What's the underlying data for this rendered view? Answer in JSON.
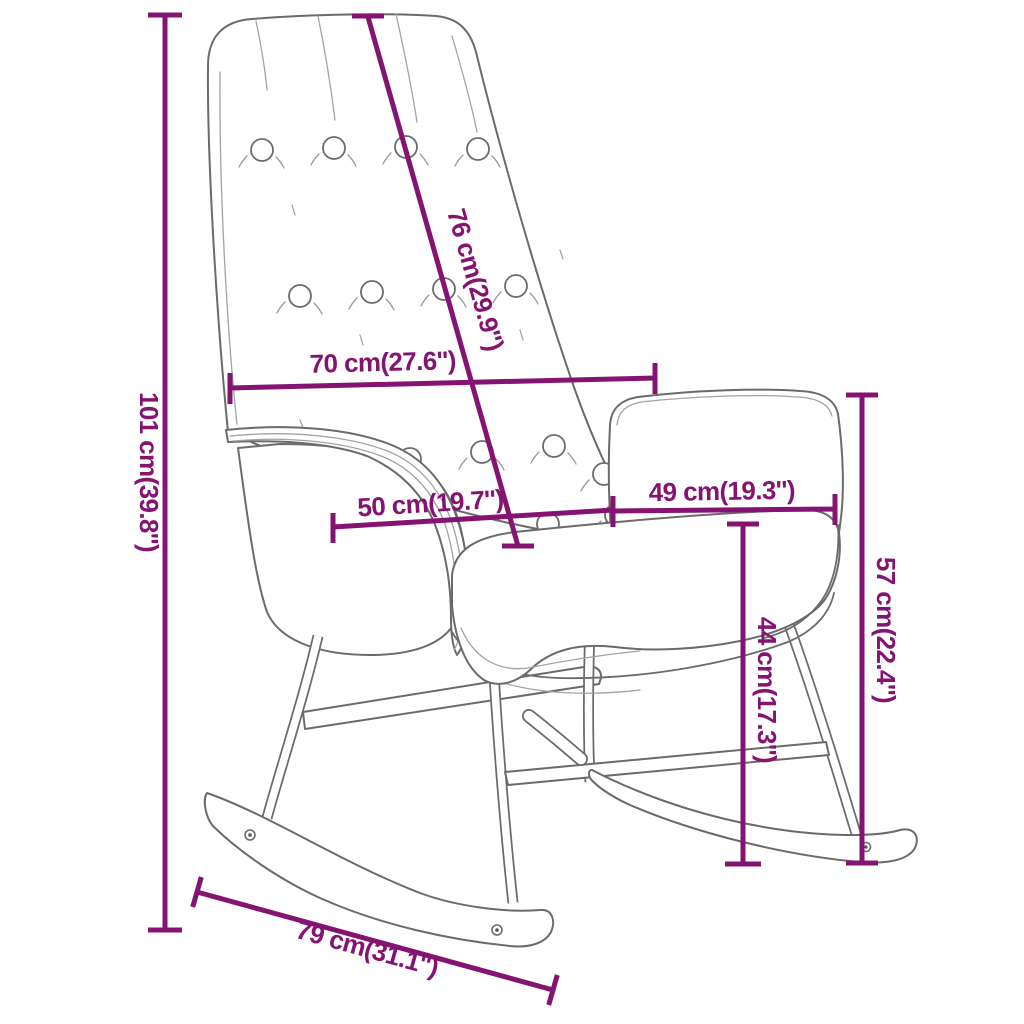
{
  "page": {
    "title": "Rocking chair dimension diagram",
    "background_color": "#ffffff"
  },
  "style": {
    "dimension_color": "#841372",
    "chair_outline_color": "#6b6b6b",
    "chair_detail_color": "#a3a3a3"
  },
  "product": {
    "type": "rocking chair",
    "view": "three-quarter line drawing with button-tufted backrest, armrest, seat cushion, metal legs and rocker runners"
  },
  "measurements": [
    {
      "id": "overall-height",
      "label": "101 cm(39.8'')",
      "cm": 101,
      "inches": 39.8,
      "orientation": "vertical"
    },
    {
      "id": "backrest-length",
      "label": "76 cm(29.9'')",
      "cm": 76,
      "inches": 29.9,
      "orientation": "diagonal"
    },
    {
      "id": "backrest-width",
      "label": "70 cm(27.6'')",
      "cm": 70,
      "inches": 27.6,
      "orientation": "horizontal"
    },
    {
      "id": "seat-width",
      "label": "50 cm(19.7'')",
      "cm": 50,
      "inches": 19.7,
      "orientation": "horizontal"
    },
    {
      "id": "armrest-depth",
      "label": "49 cm(19.3'')",
      "cm": 49,
      "inches": 19.3,
      "orientation": "horizontal"
    },
    {
      "id": "armrest-height",
      "label": "57 cm(22.4'')",
      "cm": 57,
      "inches": 22.4,
      "orientation": "vertical"
    },
    {
      "id": "seat-height",
      "label": "44 cm(17.3'')",
      "cm": 44,
      "inches": 17.3,
      "orientation": "vertical"
    },
    {
      "id": "runner-length",
      "label": "79 cm(31.1'')",
      "cm": 79,
      "inches": 31.1,
      "orientation": "diagonal"
    }
  ]
}
